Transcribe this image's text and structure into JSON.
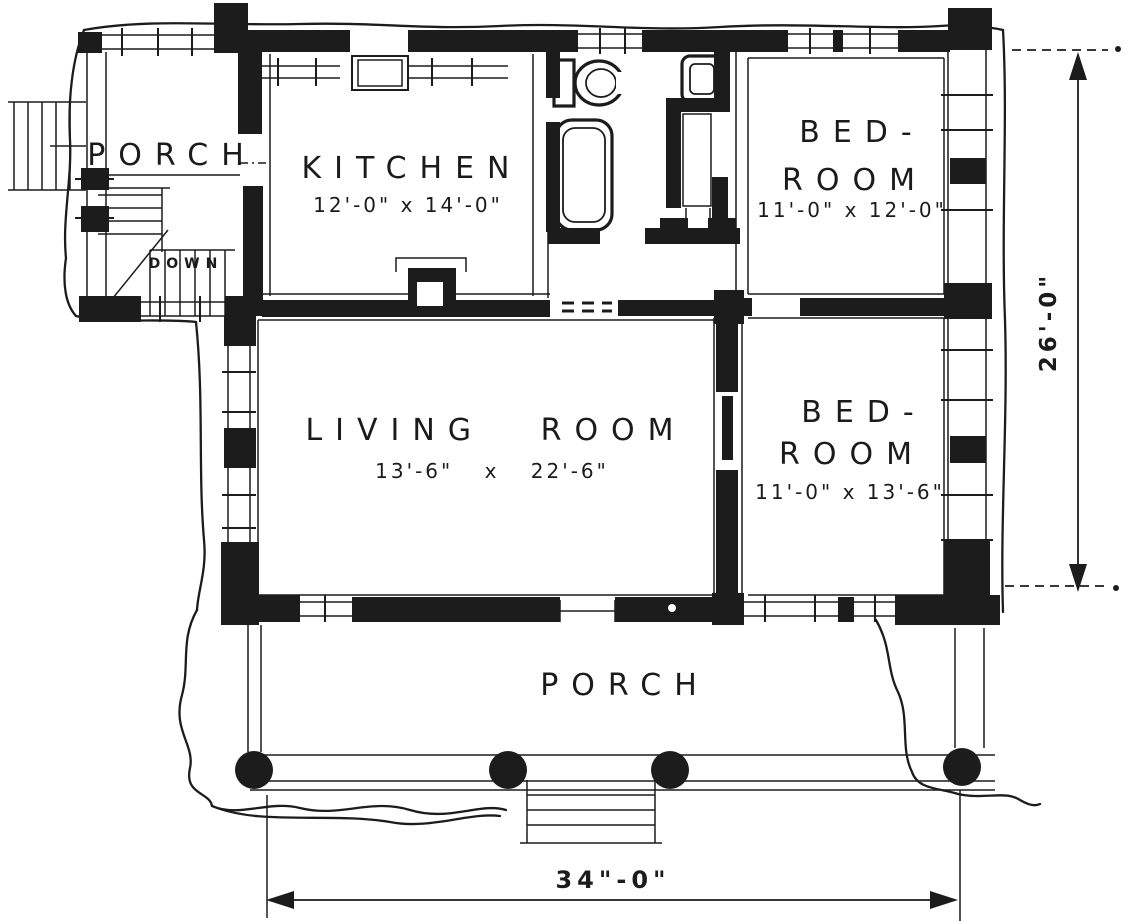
{
  "colors": {
    "ink": "#1c1c1c",
    "paper": "#ffffff"
  },
  "rooms": {
    "porch_left": {
      "name": "PORCH"
    },
    "kitchen": {
      "name": "KITCHEN",
      "size": "12'-0\" x 14'-0\""
    },
    "bedroom_top": {
      "name_line1": "BED-",
      "name_line2": "ROOM",
      "size": "11'-0\" x 12'-0\""
    },
    "living_room": {
      "name": "LIVING ROOM",
      "size": "13'-6\" x 22'-6\""
    },
    "bedroom_bottom": {
      "name_line1": "BED-",
      "name_line2": "ROOM",
      "size": "11'-0\" x 13'-6\""
    },
    "porch_front": {
      "name": "PORCH"
    }
  },
  "stairs": {
    "label": "DOWN"
  },
  "dimensions": {
    "overall_width": "34\"-0\"",
    "overall_depth": "26'-0\""
  }
}
